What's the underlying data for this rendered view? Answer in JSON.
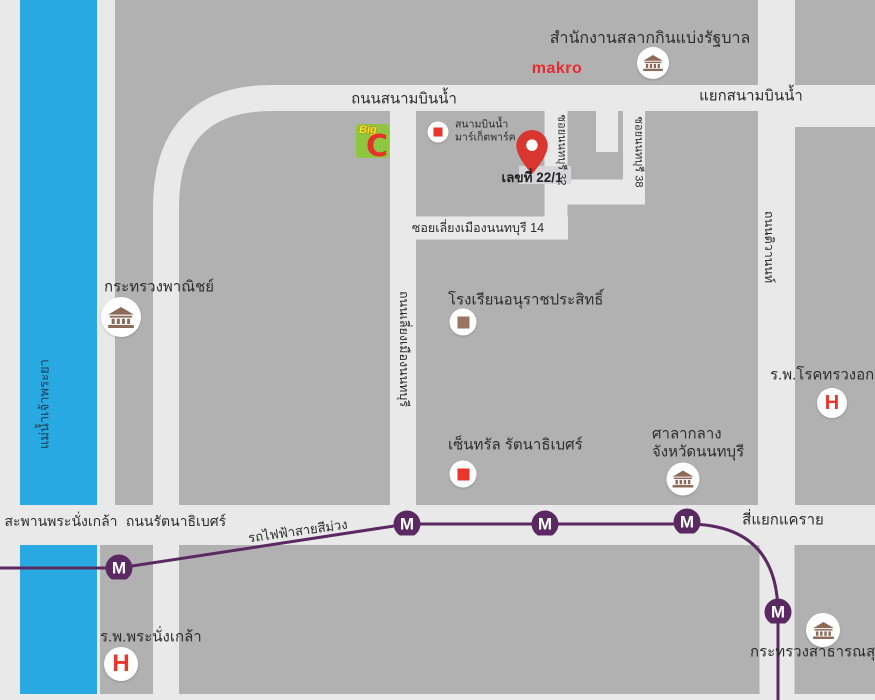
{
  "river": {
    "label": "แม่น้ำเจ้าพระยา"
  },
  "roads": {
    "sanambin_nam": "ถนนสนามบินน้ำ",
    "sanambin_nam_junction": "แยกสนามบินน้ำ",
    "soi_nonthaburi_32": "ซอยนนทบุรี 32",
    "soi_nonthaburi_38": "ซอยนนทบุรี 38",
    "soi_liang_mueang_nonthaburi_14": "ซอยเลี่ยงเมืองนนทบุรี 14",
    "liang_mueang_nonthaburi": "ถนนเลี่ยงเมืองนนทบุรี",
    "tiwanon": "ถนนติวานนท์",
    "rattanathibet": "ถนนรัตนาธิเบศร์",
    "phra_nangklao_bridge": "สะพานพระนั่งเกล้า",
    "khae_rai_intersection": "สี่แยกแคราย"
  },
  "transit": {
    "purple_line": "รถไฟฟ้าสายสีม่วง",
    "station_letter": "M"
  },
  "destination": {
    "address_label": "เลขที่ 22/1"
  },
  "landmarks": {
    "lottery_office": "สำนักงานสลากกินแบ่งรัฐบาล",
    "makro": "makro",
    "market_park_line1": "สนามบินน้ำ",
    "market_park_line2": "มาร์เก็ตพาร์ค",
    "ministry_of_commerce": "กระทรวงพาณิชย์",
    "anurat_prasit_school": "โรงเรียนอนุราชประสิทธิ์",
    "central_rattanathibet": "เซ็นทรัล รัตนาธิเบศร์",
    "provincial_hall_line1": "ศาลากลาง",
    "provincial_hall_line2": "จังหวัดนนทบุรี",
    "chest_disease_hospital": "ร.พ.โรคทรวงอก",
    "phra_nangklao_hospital": "ร.พ.พระนั่งเกล้า",
    "ministry_of_public_health": "กระทรวงสาธารณสุข",
    "hospital_letter": "H"
  },
  "brand": {
    "bigc_top": "Big",
    "bigc_c": "C"
  },
  "colors": {
    "river": "#29a9e1",
    "block": "#b1b1b1",
    "road": "#e9e9e9",
    "purple_line": "#5b2962",
    "accent_red": "#e8362d",
    "building_brown": "#8d6a58",
    "bigc_green": "#8ec63f"
  }
}
